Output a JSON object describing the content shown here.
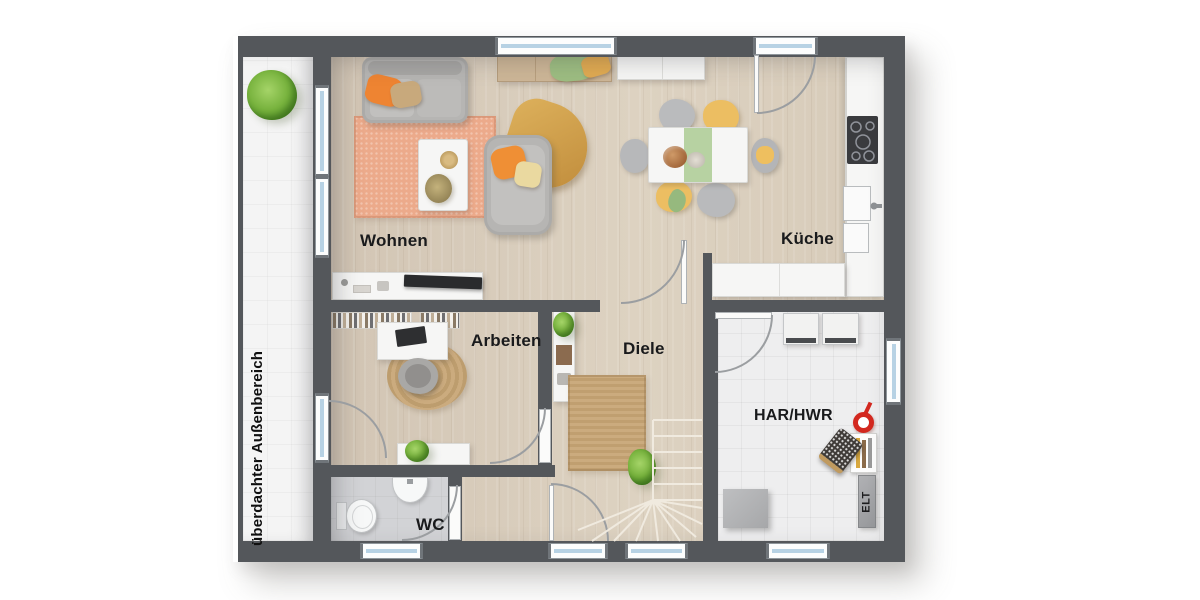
{
  "plan": {
    "title": "Erdgeschoss Grundriss",
    "rooms": {
      "wohnen": {
        "label": "Wohnen"
      },
      "kueche": {
        "label": "Küche"
      },
      "arbeiten": {
        "label": "Arbeiten"
      },
      "diele": {
        "label": "Diele"
      },
      "har_hwr": {
        "label": "HAR/HWR"
      },
      "wc": {
        "label": "WC"
      }
    },
    "annotations": {
      "elt": {
        "label": "ELT"
      },
      "outdoor": {
        "label": "überdachter Außenbereich"
      }
    },
    "colors": {
      "wall": "#54575b",
      "floor_wood": "#d8ccba",
      "floor_tile": "#eeeeef",
      "floor_wc": "#d2d3d6",
      "outdoor_area": "#f4f4f4",
      "rug_salmon": "#ecaa8b",
      "rug_jute": "#c7a97d",
      "accent_orange": "#ee8c38",
      "accent_yellow": "#ecbe62",
      "accent_green": "#a9c993",
      "window_glass": "#b7d2e4",
      "bucket_red": "#d3281f"
    }
  }
}
